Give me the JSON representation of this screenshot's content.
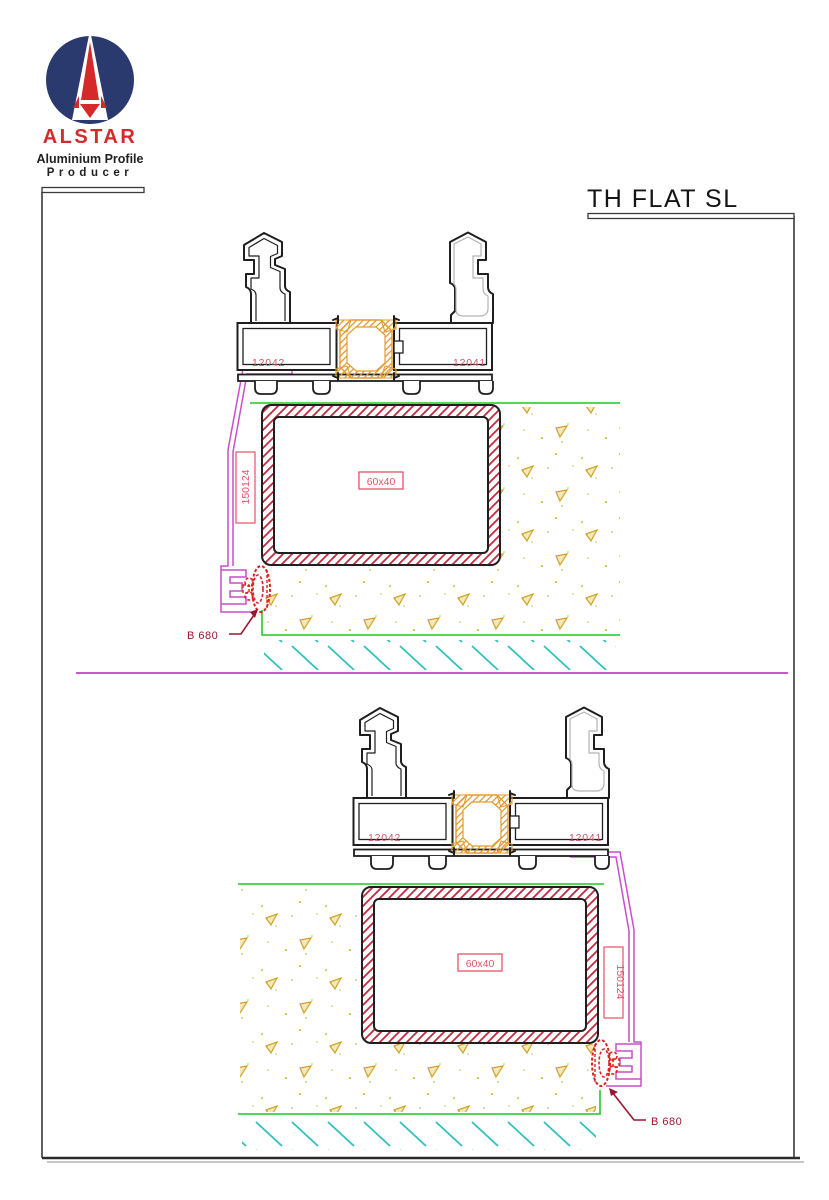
{
  "brand": {
    "name": "ALSTAR",
    "tagline_line1": "Aluminium Profile",
    "tagline_line2": "Producer"
  },
  "drawing": {
    "title": "TH FLAT SL"
  },
  "profiles": {
    "sash_profile": "12042",
    "frame_profile": "12041",
    "subsill_profile": "150124",
    "steel_tube": "60x40",
    "gasket": "B 680"
  },
  "colors": {
    "logo_navy": "#2b3a6e",
    "brand_red": "#d42a2a",
    "profile_outline": "#1f1f1f",
    "thermal_break_orange": "#e59a2f",
    "steel_hatch_red": "#c6283c",
    "subsill_magenta": "#c94fcc",
    "ground_green": "#3ecf3e",
    "section_hatch_teal": "#2fc0c0",
    "concrete_stipple_tan": "#cfa32a",
    "profile_label_pink": "#cc5566",
    "callout_dark_red": "#99182e",
    "divider_magenta": "#cc55cc"
  }
}
